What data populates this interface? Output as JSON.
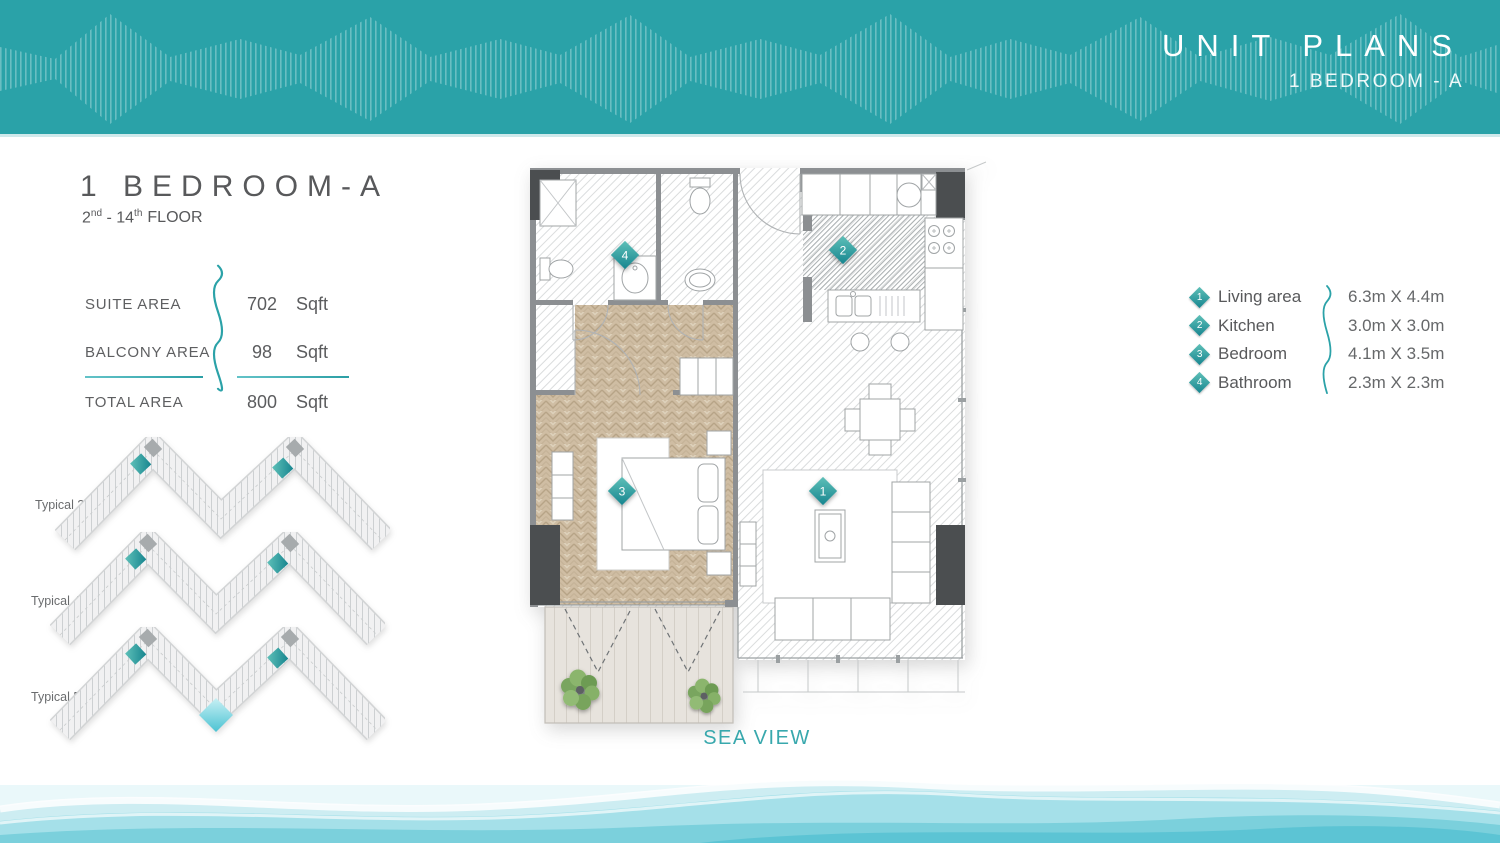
{
  "header": {
    "title": "UNIT PLANS",
    "subtitle": "1 BEDROOM - A"
  },
  "unit": {
    "title": "1 BEDROOM-A",
    "floor_from": "2",
    "floor_from_sup": "nd",
    "floor_sep": " - ",
    "floor_to": "14",
    "floor_to_sup": "th",
    "floor_word": "FLOOR"
  },
  "areas": {
    "rows": [
      {
        "label": "SUITE AREA",
        "value": "702",
        "unit": "Sqft"
      },
      {
        "label": "BALCONY AREA",
        "value": "98",
        "unit": "Sqft"
      },
      {
        "label": "TOTAL AREA",
        "value": "800",
        "unit": "Sqft"
      }
    ]
  },
  "typicals": [
    {
      "label": "Typical 3"
    },
    {
      "label": "Typical 4"
    },
    {
      "label": "Typical 5"
    }
  ],
  "legend": {
    "items": [
      {
        "num": "1",
        "label": "Living area",
        "dims": "6.3m X 4.4m"
      },
      {
        "num": "2",
        "label": "Kitchen",
        "dims": "3.0m X 3.0m"
      },
      {
        "num": "3",
        "label": "Bedroom",
        "dims": "4.1m X 3.5m"
      },
      {
        "num": "4",
        "label": "Bathroom",
        "dims": "2.3m X 2.3m"
      }
    ]
  },
  "plan": {
    "markers": [
      {
        "num": "1"
      },
      {
        "num": "2"
      },
      {
        "num": "3"
      },
      {
        "num": "4"
      }
    ],
    "sea_view": "SEA VIEW"
  },
  "colors": {
    "banner_teal": "#2AA2A8",
    "accent_teal": "#2BA2A8",
    "marker_teal_light": "#5EC0B8",
    "marker_teal_dark": "#17858F",
    "sea_view_text": "#38A8AD",
    "title_gray": "#58595B"
  }
}
